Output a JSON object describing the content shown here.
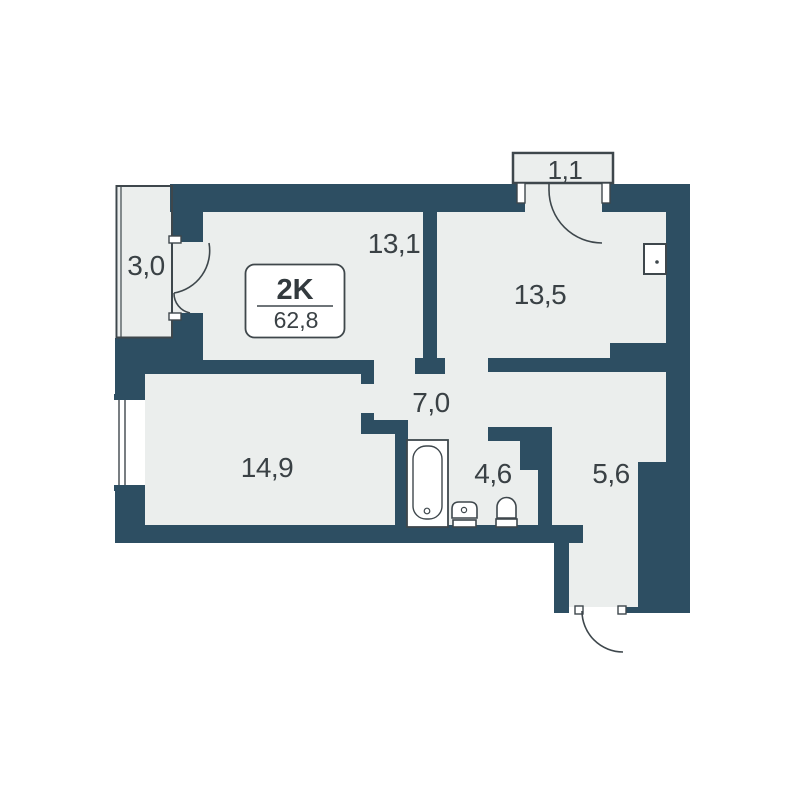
{
  "plan": {
    "type_label": "2K",
    "total_area": "62,8",
    "rooms": [
      {
        "name": "balcony-left",
        "label": "3,0"
      },
      {
        "name": "bedroom",
        "label": "13,1"
      },
      {
        "name": "balcony-top",
        "label": "1,1"
      },
      {
        "name": "room-right",
        "label": "13,5"
      },
      {
        "name": "hallway",
        "label": "7,0"
      },
      {
        "name": "living-room",
        "label": "14,9"
      },
      {
        "name": "bathroom",
        "label": "4,6"
      },
      {
        "name": "entry-hall",
        "label": "5,6"
      }
    ],
    "fixtures": [
      "bathtub-icon",
      "sink-icon",
      "toilet-icon",
      "electrical-panel-icon",
      "window-icon"
    ],
    "colors": {
      "wall": "#2d4e62",
      "floor_fill": "#ebeeed",
      "background": "#ffffff",
      "outline": "#3e474c",
      "text": "#3a4145"
    }
  }
}
